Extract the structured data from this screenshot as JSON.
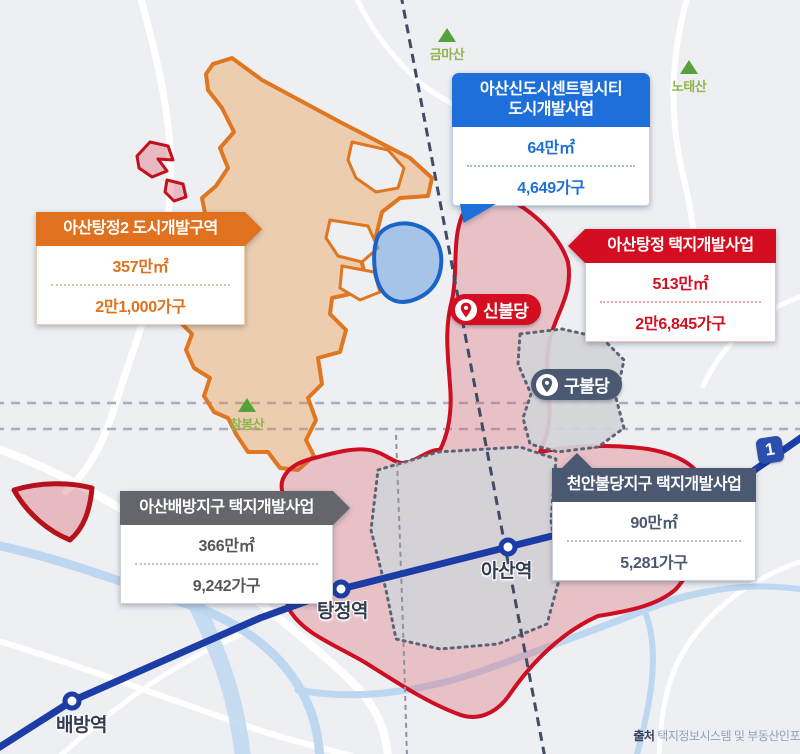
{
  "callouts": {
    "centralcity": {
      "title1": "아산신도시센트럴시티",
      "title2": "도시개발사업",
      "area": "64만㎡",
      "households": "4,649가구",
      "color": "#1e6fd9"
    },
    "tangjeong2": {
      "title": "아산탕정2 도시개발구역",
      "area": "357만㎡",
      "households": "2만1,000가구",
      "color": "#e0711e"
    },
    "tangjeong": {
      "title": "아산탕정 택지개발사업",
      "area": "513만㎡",
      "households": "2만6,845가구",
      "color": "#d40e20"
    },
    "baebang": {
      "title": "아산배방지구 택지개발사업",
      "area": "366만㎡",
      "households": "9,242가구",
      "color": "#64666c"
    },
    "cheonanbuldang": {
      "title": "천안불당지구 택지개발사업",
      "area": "90만㎡",
      "households": "5,281가구",
      "color": "#4b5871"
    }
  },
  "markers": {
    "sinbuldang": {
      "label": "신불당",
      "color": "#d40e20"
    },
    "gubuldang": {
      "label": "구불당",
      "color": "#4b5871"
    }
  },
  "mountains": {
    "geumma": {
      "name": "금마산"
    },
    "notae": {
      "name": "노태산"
    },
    "chambong": {
      "name": "참봉산"
    }
  },
  "stations": {
    "tangjeong": {
      "name": "탕정역"
    },
    "asan": {
      "name": "아산역"
    },
    "baebang": {
      "name": "배방역"
    }
  },
  "line_badge": {
    "label": "1"
  },
  "source": {
    "prefix": "출처",
    "text": "택지정보시스템 및 부동산인포"
  },
  "map_colors": {
    "background": "#edeff3",
    "road": "#ffffff",
    "river": "#bdd7f0",
    "railway": "#1c3da6",
    "orange_zone_border": "#e0761f",
    "blue_zone_border": "#1a64c8",
    "red_zone_border": "#ce0e22",
    "gray_zone_border": "#5c6474",
    "mountain_green": "#55a13b"
  }
}
